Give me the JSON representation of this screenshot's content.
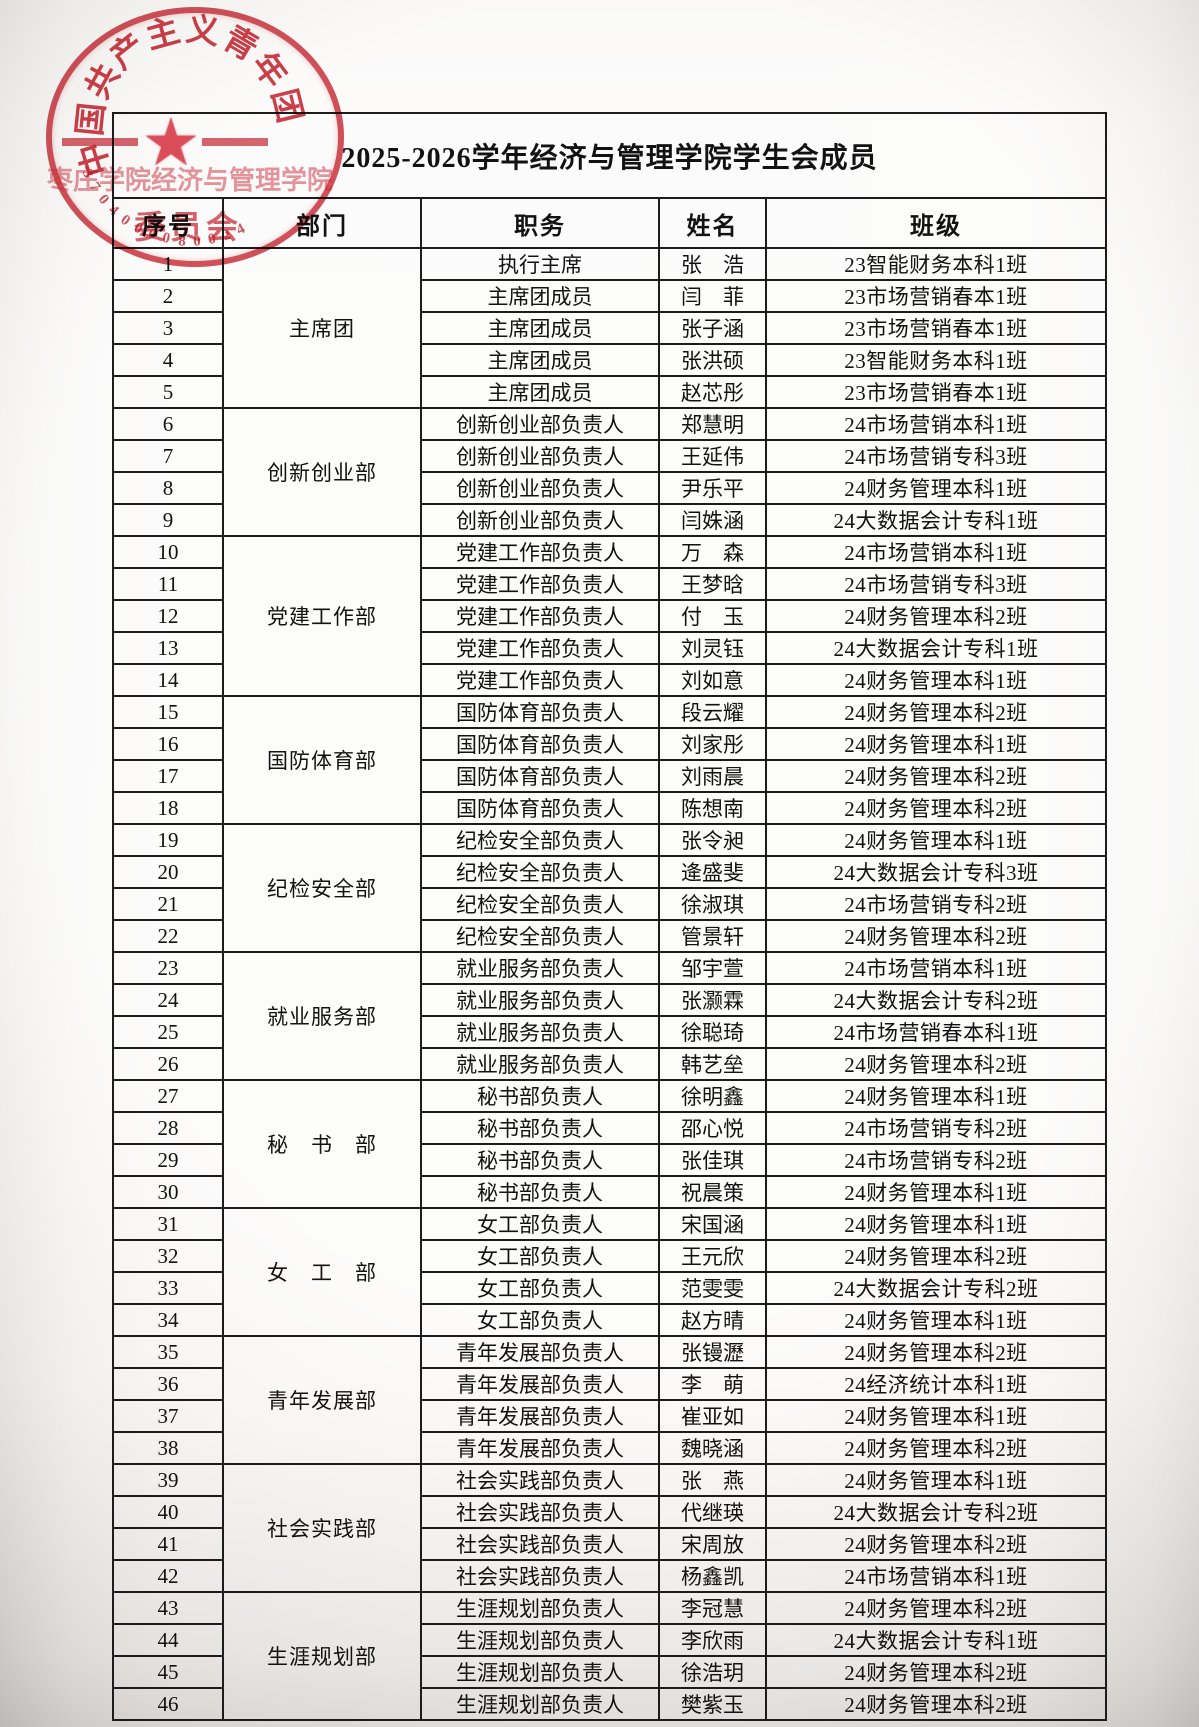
{
  "page": {
    "title": "2025-2026学年经济与管理学院学生会成员"
  },
  "stamp": {
    "arc_text": "中国共产主义青年团",
    "org_line1": "枣庄学院经济与管理学院",
    "org_line2": "委员会",
    "serial": "3704000080024",
    "star_glyph": "★",
    "color": "#c7202c"
  },
  "table": {
    "headers": [
      "序号",
      "部门",
      "职务",
      "姓名",
      "班级"
    ],
    "groups": [
      {
        "dept": "主席团",
        "rows": [
          {
            "no": "1",
            "position": "执行主席",
            "name": "张　浩",
            "class": "23智能财务本科1班"
          },
          {
            "no": "2",
            "position": "主席团成员",
            "name": "闫　菲",
            "class": "23市场营销春本1班"
          },
          {
            "no": "3",
            "position": "主席团成员",
            "name": "张子涵",
            "class": "23市场营销春本1班"
          },
          {
            "no": "4",
            "position": "主席团成员",
            "name": "张洪硕",
            "class": "23智能财务本科1班"
          },
          {
            "no": "5",
            "position": "主席团成员",
            "name": "赵芯彤",
            "class": "23市场营销春本1班"
          }
        ]
      },
      {
        "dept": "创新创业部",
        "rows": [
          {
            "no": "6",
            "position": "创新创业部负责人",
            "name": "郑慧明",
            "class": "24市场营销本科1班"
          },
          {
            "no": "7",
            "position": "创新创业部负责人",
            "name": "王延伟",
            "class": "24市场营销专科3班"
          },
          {
            "no": "8",
            "position": "创新创业部负责人",
            "name": "尹乐平",
            "class": "24财务管理本科1班"
          },
          {
            "no": "9",
            "position": "创新创业部负责人",
            "name": "闫姝涵",
            "class": "24大数据会计专科1班"
          }
        ]
      },
      {
        "dept": "党建工作部",
        "rows": [
          {
            "no": "10",
            "position": "党建工作部负责人",
            "name": "万　森",
            "class": "24市场营销本科1班"
          },
          {
            "no": "11",
            "position": "党建工作部负责人",
            "name": "王梦晗",
            "class": "24市场营销专科3班"
          },
          {
            "no": "12",
            "position": "党建工作部负责人",
            "name": "付　玉",
            "class": "24财务管理本科2班"
          },
          {
            "no": "13",
            "position": "党建工作部负责人",
            "name": "刘灵钰",
            "class": "24大数据会计专科1班"
          },
          {
            "no": "14",
            "position": "党建工作部负责人",
            "name": "刘如意",
            "class": "24财务管理本科1班"
          }
        ]
      },
      {
        "dept": "国防体育部",
        "rows": [
          {
            "no": "15",
            "position": "国防体育部负责人",
            "name": "段云耀",
            "class": "24财务管理本科2班"
          },
          {
            "no": "16",
            "position": "国防体育部负责人",
            "name": "刘家彤",
            "class": "24财务管理本科1班"
          },
          {
            "no": "17",
            "position": "国防体育部负责人",
            "name": "刘雨晨",
            "class": "24财务管理本科2班"
          },
          {
            "no": "18",
            "position": "国防体育部负责人",
            "name": "陈想南",
            "class": "24财务管理本科2班"
          }
        ]
      },
      {
        "dept": "纪检安全部",
        "rows": [
          {
            "no": "19",
            "position": "纪检安全部负责人",
            "name": "张令昶",
            "class": "24财务管理本科1班"
          },
          {
            "no": "20",
            "position": "纪检安全部负责人",
            "name": "逄盛斐",
            "class": "24大数据会计专科3班"
          },
          {
            "no": "21",
            "position": "纪检安全部负责人",
            "name": "徐淑琪",
            "class": "24市场营销专科2班"
          },
          {
            "no": "22",
            "position": "纪检安全部负责人",
            "name": "管景轩",
            "class": "24财务管理本科2班"
          }
        ]
      },
      {
        "dept": "就业服务部",
        "rows": [
          {
            "no": "23",
            "position": "就业服务部负责人",
            "name": "邹宇萱",
            "class": "24市场营销本科1班"
          },
          {
            "no": "24",
            "position": "就业服务部负责人",
            "name": "张灏霖",
            "class": "24大数据会计专科2班"
          },
          {
            "no": "25",
            "position": "就业服务部负责人",
            "name": "徐聪琦",
            "class": "24市场营销春本科1班"
          },
          {
            "no": "26",
            "position": "就业服务部负责人",
            "name": "韩艺垒",
            "class": "24财务管理本科2班"
          }
        ]
      },
      {
        "dept": "秘　书　部",
        "rows": [
          {
            "no": "27",
            "position": "秘书部负责人",
            "name": "徐明鑫",
            "class": "24财务管理本科1班"
          },
          {
            "no": "28",
            "position": "秘书部负责人",
            "name": "邵心悦",
            "class": "24市场营销专科2班"
          },
          {
            "no": "29",
            "position": "秘书部负责人",
            "name": "张佳琪",
            "class": "24市场营销专科2班"
          },
          {
            "no": "30",
            "position": "秘书部负责人",
            "name": "祝晨策",
            "class": "24财务管理本科1班"
          }
        ]
      },
      {
        "dept": "女　工　部",
        "rows": [
          {
            "no": "31",
            "position": "女工部负责人",
            "name": "宋国涵",
            "class": "24财务管理本科1班"
          },
          {
            "no": "32",
            "position": "女工部负责人",
            "name": "王元欣",
            "class": "24财务管理本科2班"
          },
          {
            "no": "33",
            "position": "女工部负责人",
            "name": "范雯雯",
            "class": "24大数据会计专科2班"
          },
          {
            "no": "34",
            "position": "女工部负责人",
            "name": "赵方晴",
            "class": "24财务管理本科1班"
          }
        ]
      },
      {
        "dept": "青年发展部",
        "rows": [
          {
            "no": "35",
            "position": "青年发展部负责人",
            "name": "张镘瀝",
            "class": "24财务管理本科2班"
          },
          {
            "no": "36",
            "position": "青年发展部负责人",
            "name": "李　萌",
            "class": "24经济统计本科1班"
          },
          {
            "no": "37",
            "position": "青年发展部负责人",
            "name": "崔亚如",
            "class": "24财务管理本科1班"
          },
          {
            "no": "38",
            "position": "青年发展部负责人",
            "name": "魏晓涵",
            "class": "24财务管理本科2班"
          }
        ]
      },
      {
        "dept": "社会实践部",
        "rows": [
          {
            "no": "39",
            "position": "社会实践部负责人",
            "name": "张　燕",
            "class": "24财务管理本科1班"
          },
          {
            "no": "40",
            "position": "社会实践部负责人",
            "name": "代继瑛",
            "class": "24大数据会计专科2班"
          },
          {
            "no": "41",
            "position": "社会实践部负责人",
            "name": "宋周放",
            "class": "24财务管理本科2班"
          },
          {
            "no": "42",
            "position": "社会实践部负责人",
            "name": "杨鑫凯",
            "class": "24市场营销本科1班"
          }
        ]
      },
      {
        "dept": "生涯规划部",
        "rows": [
          {
            "no": "43",
            "position": "生涯规划部负责人",
            "name": "李冠慧",
            "class": "24财务管理本科2班"
          },
          {
            "no": "44",
            "position": "生涯规划部负责人",
            "name": "李欣雨",
            "class": "24大数据会计专科1班"
          },
          {
            "no": "45",
            "position": "生涯规划部负责人",
            "name": "徐浩玥",
            "class": "24财务管理本科2班"
          },
          {
            "no": "46",
            "position": "生涯规划部负责人",
            "name": "樊紫玉",
            "class": "24财务管理本科2班"
          }
        ]
      }
    ]
  }
}
